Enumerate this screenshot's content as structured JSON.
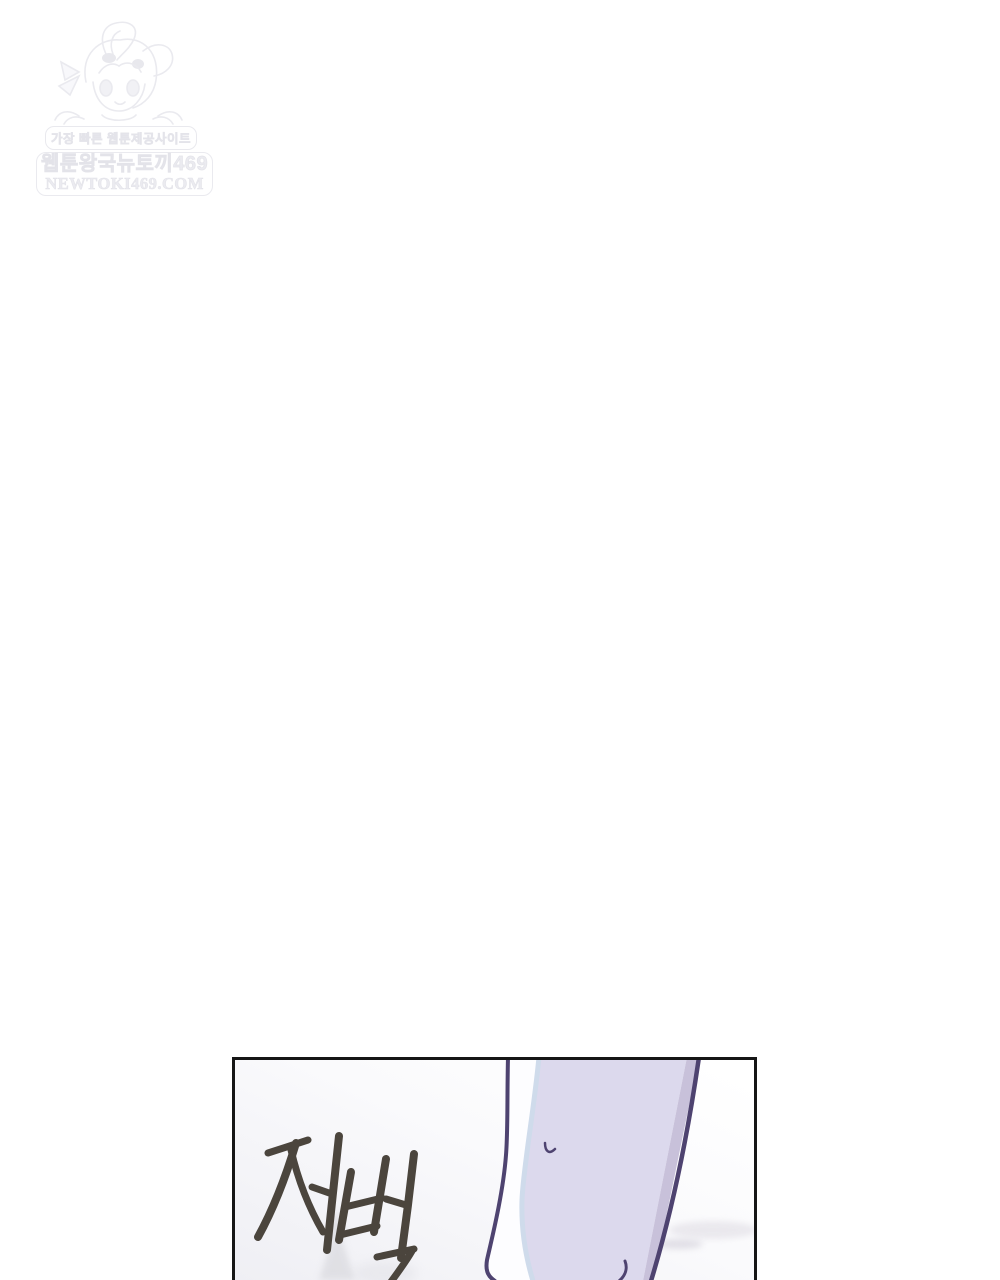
{
  "page": {
    "background_color": "#ffffff"
  },
  "watermark": {
    "character": "bunny-hood-girl-mascot",
    "line1": "가장 빠른 웹툰제공사이트",
    "line2": "웹툰왕국뉴토끼469",
    "line3": "NEWTOKI469.COM",
    "color": "#e9e9ee"
  },
  "panel": {
    "sfx_text": "저벅",
    "border_color": "#161616",
    "art": "walking-leg-in-lavender-trousers",
    "colors": {
      "fabric": "#dcd9ed",
      "fabric_shadow": "#c8c1da",
      "line_art": "#4e4370",
      "highlight_strip": "#cfdbeb",
      "sfx_stroke": "#4b453d"
    }
  }
}
